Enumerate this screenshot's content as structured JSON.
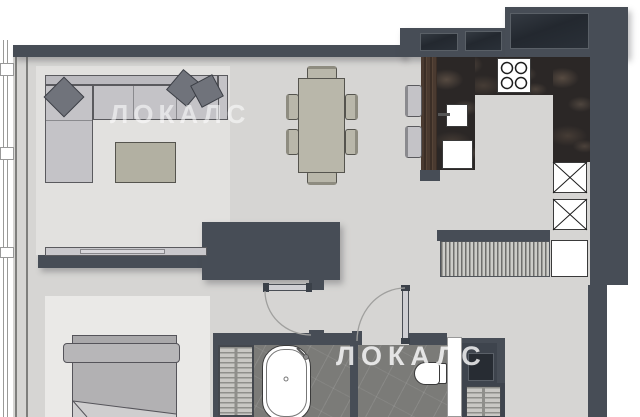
{
  "watermarks": {
    "primary": {
      "text": "ЛОКАЛС"
    },
    "secondary": {
      "text": "ЛОКАЛС"
    }
  },
  "palette": {
    "wall": "#474d56",
    "floor": "#d6d5d3",
    "living_rug": "#e2e1df",
    "bedroom_rug": "#eae9e7",
    "bathroom_floor": "#7b7b78",
    "marble_counter": "#2b2726",
    "wood_counter": "#453629",
    "furniture_gray": "#c4c3c7",
    "furniture_khaki": "#b9b7aa",
    "pillow": "#70737b",
    "fixture_white": "#ffffff"
  },
  "furniture_icons": [
    "corner-sofa",
    "throw-pillows",
    "coffee-table",
    "tv-sideboard",
    "dining-table",
    "dining-chairs-x6",
    "bar-stools-x2",
    "kitchen-counter-marble",
    "stove-4-burners",
    "kitchen-sink",
    "dishwasher",
    "tall-cabinets-x2",
    "entry-slat-console",
    "entry-cabinet",
    "double-bed",
    "bathtub",
    "toilet",
    "bath-shelf",
    "vanity",
    "towel-radiator",
    "balcony-radiator-strip",
    "door-swing-x2"
  ]
}
